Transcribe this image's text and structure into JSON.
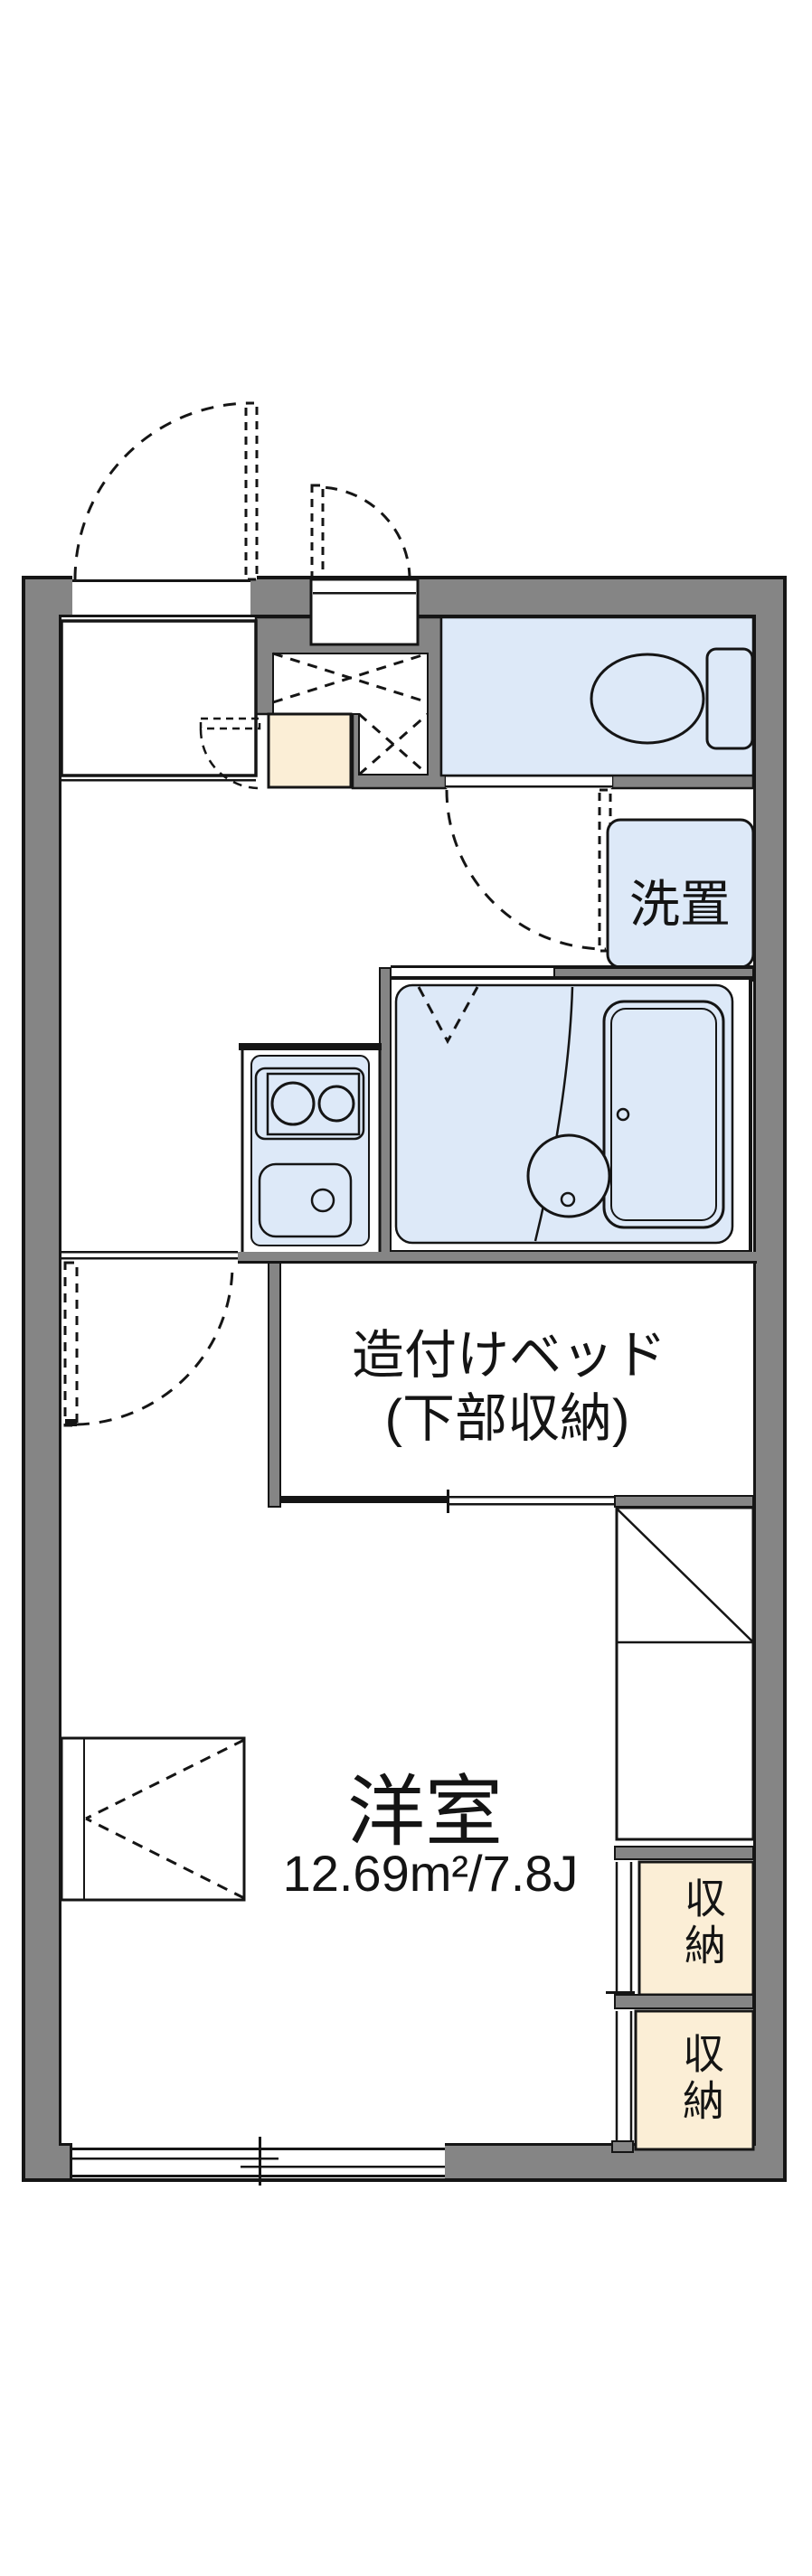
{
  "floorplan": {
    "title": "apartment floor plan",
    "labels": {
      "washer_place": "洗置",
      "built_in_bed_line1": "造付けベッド",
      "built_in_bed_line2": "(下部収納)",
      "room_name": "洋室",
      "room_area": "12.69m²/7.8J",
      "storage_upper": "収納",
      "storage_lower": "収納"
    },
    "colors": {
      "wall_gray": "#858585",
      "line_black": "#151515",
      "water_blue": "#dde9f8",
      "storage_cream": "#fbeed6",
      "background": "#ffffff"
    }
  }
}
